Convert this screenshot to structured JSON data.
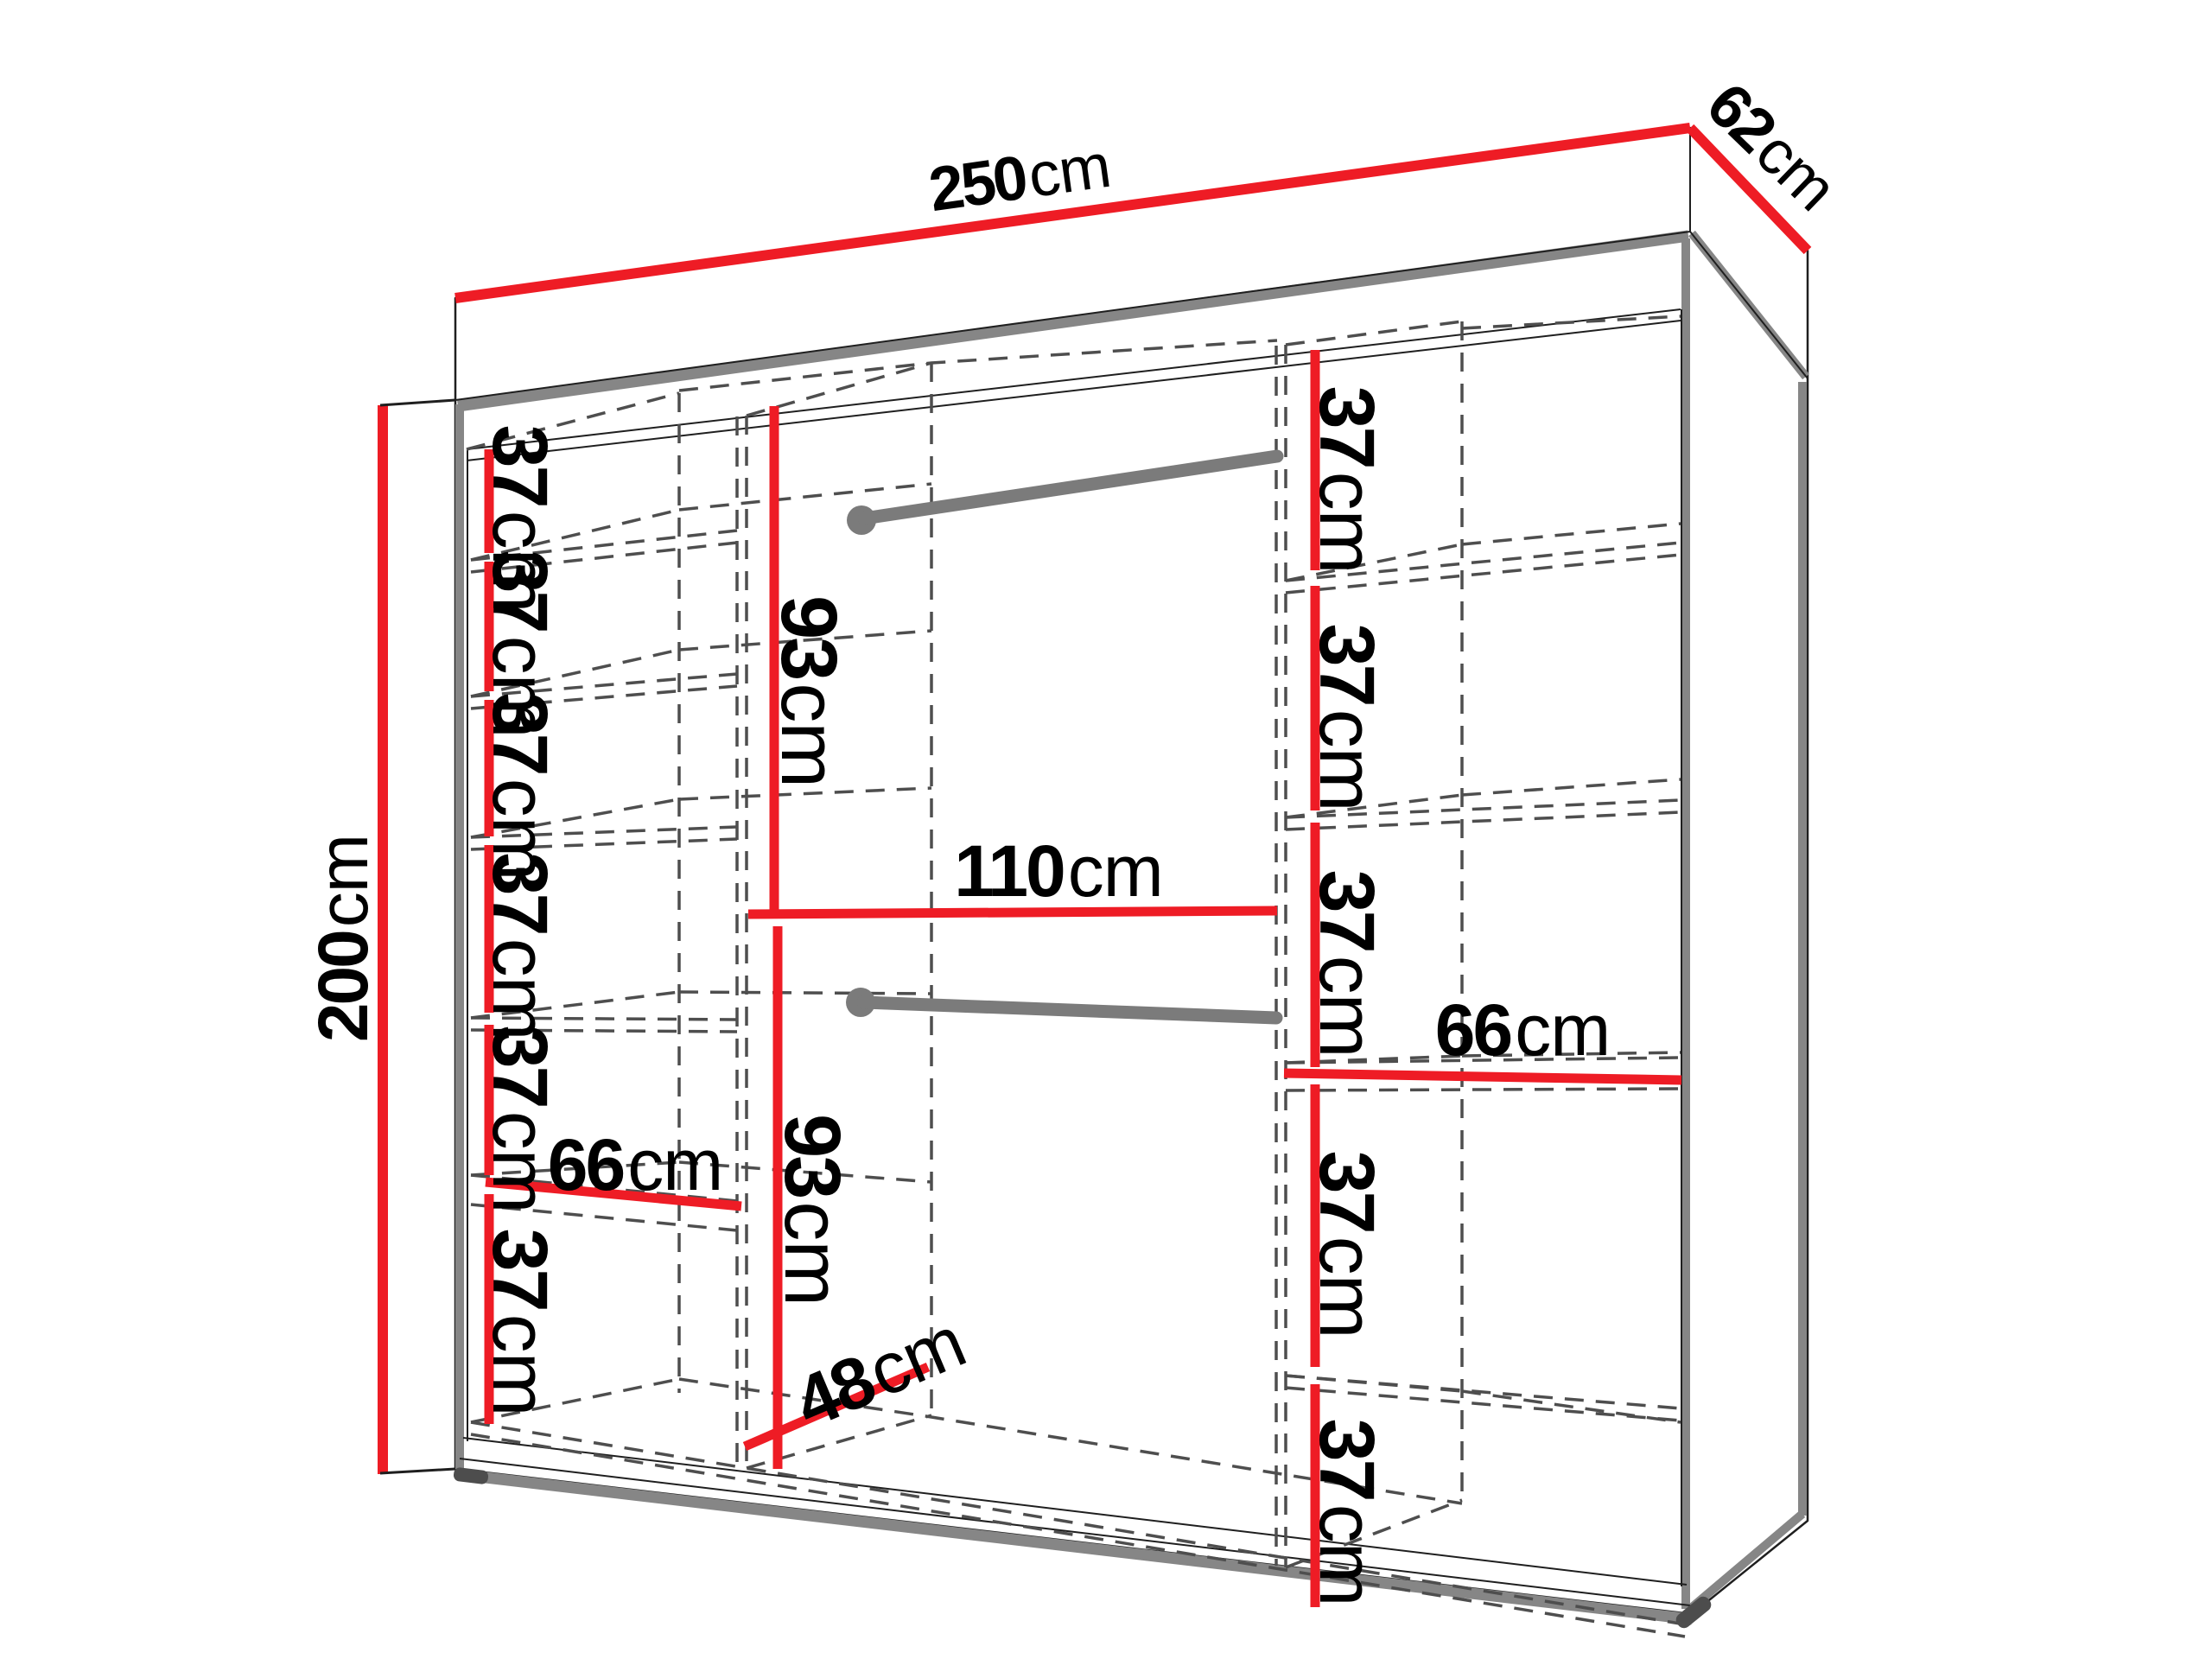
{
  "colors": {
    "bg": "#ffffff",
    "red": "#ee1c25",
    "gray": "#868686",
    "rail": "#7b7b7b",
    "dash": "#4e4e4e",
    "outline": "#1f1f1f",
    "text": "#000000"
  },
  "labels": {
    "width": {
      "value": "250",
      "unit": "cm"
    },
    "depth": {
      "value": "62",
      "unit": "cm"
    },
    "height": {
      "value": "200",
      "unit": "cm"
    },
    "upper_hanging_height": {
      "value": "93",
      "unit": "cm"
    },
    "lower_hanging_height": {
      "value": "93",
      "unit": "cm"
    },
    "hanging_width": {
      "value": "110",
      "unit": "cm"
    },
    "left_shelf_width": {
      "value": "66",
      "unit": "cm"
    },
    "right_shelf_width": {
      "value": "66",
      "unit": "cm"
    },
    "bottom_depth": {
      "value": "48",
      "unit": "cm"
    },
    "left_shelf_heights": [
      {
        "value": "37",
        "unit": "cm"
      },
      {
        "value": "37",
        "unit": "cm"
      },
      {
        "value": "37",
        "unit": "cm"
      },
      {
        "value": "37",
        "unit": "cm"
      },
      {
        "value": "37",
        "unit": "cm"
      },
      {
        "value": "37",
        "unit": "cm"
      }
    ],
    "right_shelf_heights": [
      {
        "value": "37",
        "unit": "cm"
      },
      {
        "value": "37",
        "unit": "cm"
      },
      {
        "value": "37",
        "unit": "cm"
      },
      {
        "value": "37",
        "unit": "cm"
      },
      {
        "value": "37",
        "unit": "cm"
      }
    ]
  }
}
